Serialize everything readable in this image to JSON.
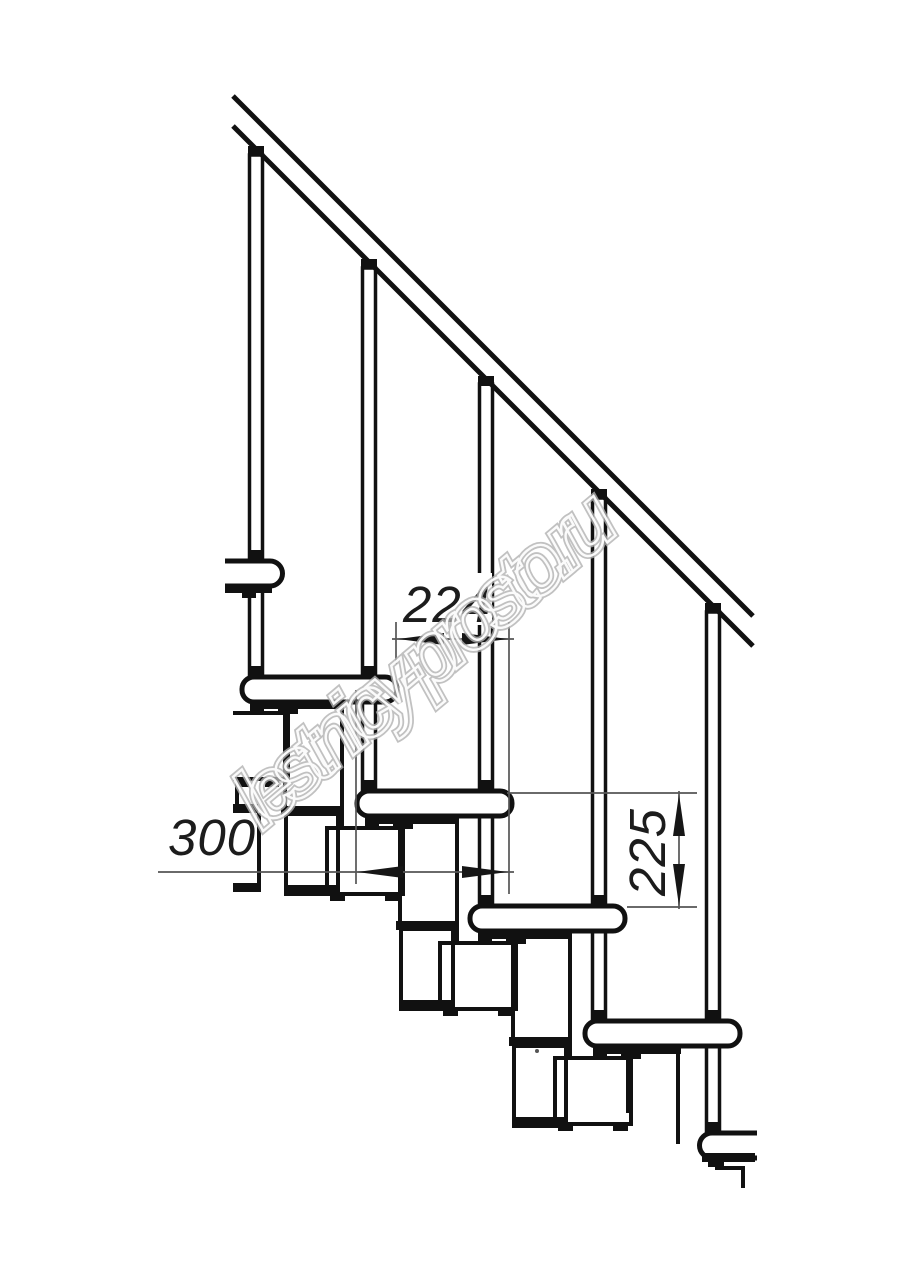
{
  "document": {
    "kind": "technical-drawing",
    "subject": "modular staircase side elevation fragment",
    "background": "#ffffff"
  },
  "watermark": {
    "text": "lestnicy-prosto.ru",
    "color": "#b2b2b2"
  },
  "dimensions": {
    "step_run": {
      "label": "224",
      "orientation": "horizontal"
    },
    "tread_depth": {
      "label": "300",
      "orientation": "horizontal"
    },
    "step_rise": {
      "label": "225",
      "orientation": "vertical"
    }
  },
  "elements": {
    "treads_visible": 6,
    "balusters_visible": 5,
    "handrail_lines": 2,
    "support_type": "modular chain under treads"
  },
  "colors": {
    "drawing_line": "#111111",
    "dimension_line": "#565656",
    "dimension_text": "#1c1c1c"
  }
}
